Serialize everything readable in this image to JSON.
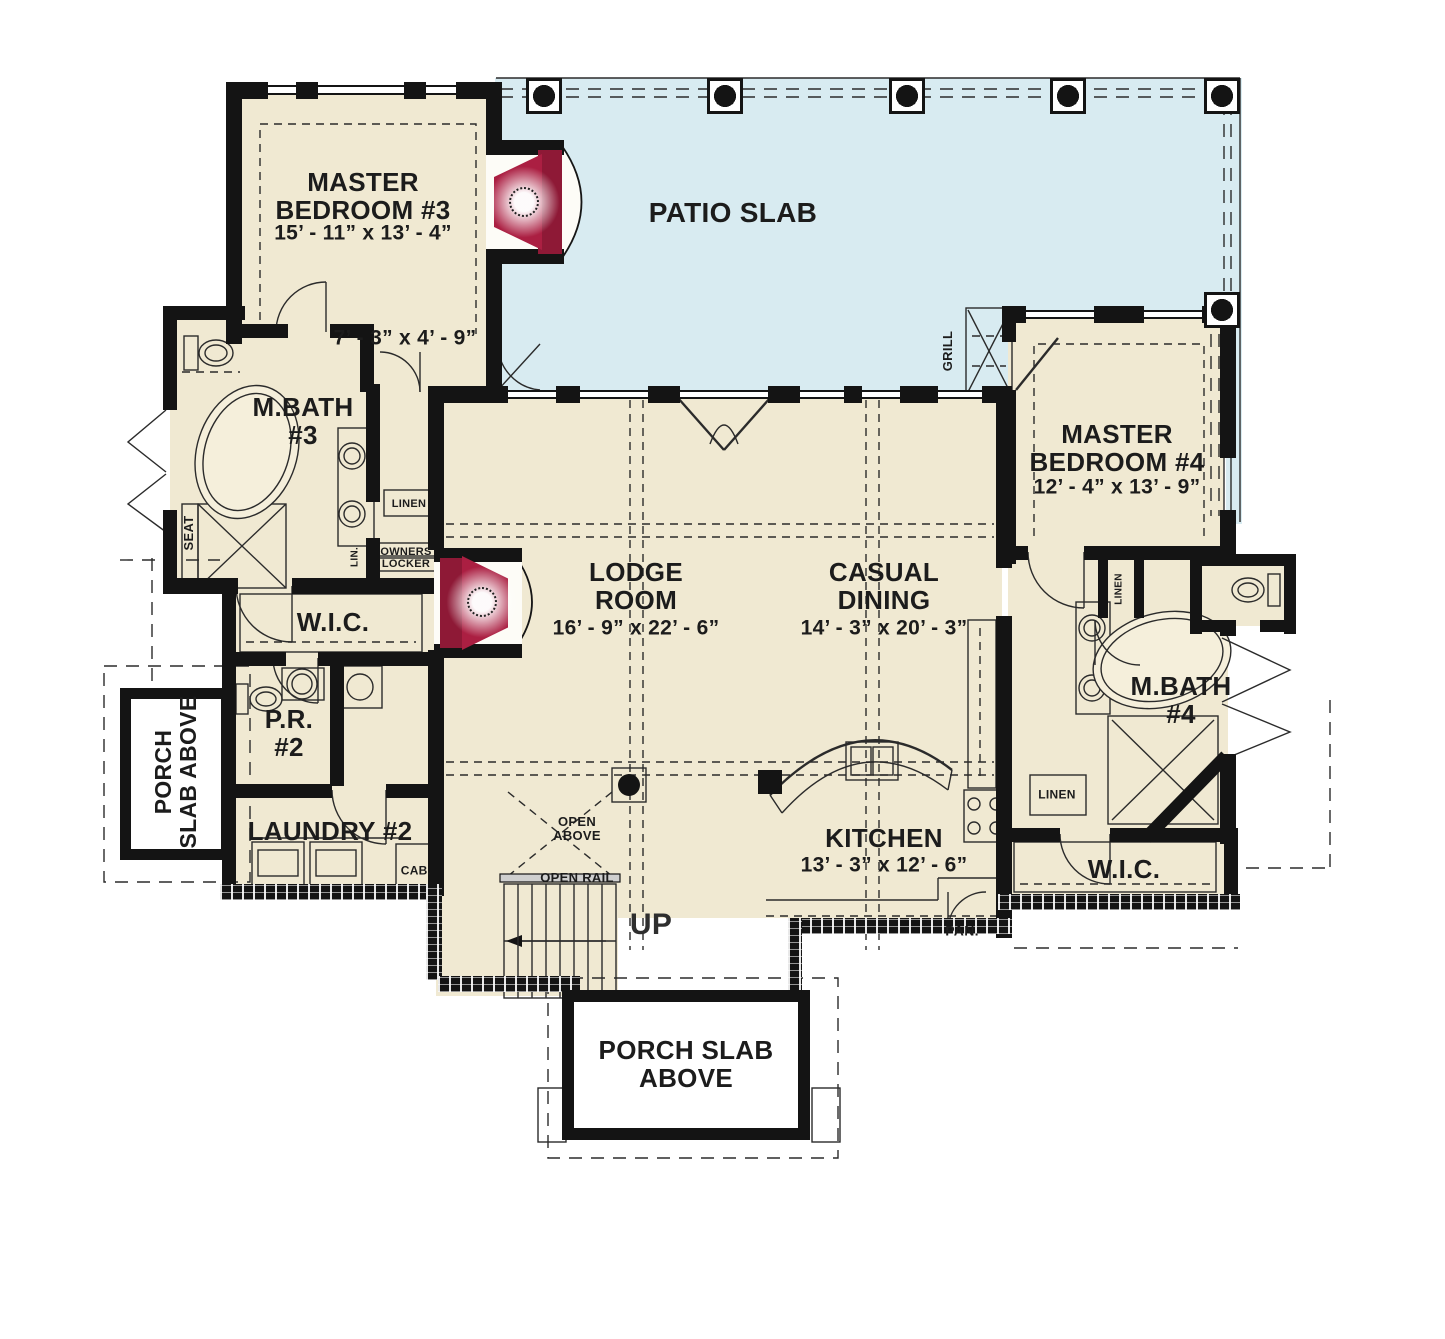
{
  "colors": {
    "interior": "#f0e9d2",
    "patio": "#d8ebf1",
    "wall": "#141414",
    "accent_red": "#ab1f42",
    "line": "#2b2b2b"
  },
  "rooms": {
    "patio": {
      "name": "PATIO SLAB"
    },
    "master_bedroom_3": {
      "name": "MASTER\nBEDROOM #3",
      "dims": "15’ - 11” x 13’ - 4”"
    },
    "vestibule": {
      "dims": "7’ - 3” x 4’ - 9”"
    },
    "m_bath_3": {
      "name": "M.BATH\n#3"
    },
    "wic_left": {
      "name": "W.I.C."
    },
    "powder_2": {
      "name": "P.R.\n#2"
    },
    "laundry_2": {
      "name": "LAUNDRY #2"
    },
    "lodge_room": {
      "name": "LODGE\nROOM",
      "dims": "16’ - 9” x 22’ - 6”"
    },
    "casual_dining": {
      "name": "CASUAL\nDINING",
      "dims": "14’ - 3” x 20’ - 3”"
    },
    "kitchen": {
      "name": "KITCHEN",
      "dims": "13’ - 3” x 12’ - 6”"
    },
    "master_bedroom_4": {
      "name": "MASTER\nBEDROOM #4",
      "dims": "12’ - 4” x 13’ - 9”"
    },
    "m_bath_4": {
      "name": "M.BATH\n#4"
    },
    "wic_right": {
      "name": "W.I.C."
    },
    "porch_left": {
      "name": "PORCH\nSLAB ABOVE"
    },
    "porch_bottom": {
      "name": "PORCH SLAB\nABOVE"
    }
  },
  "annotations": {
    "seat": "SEAT",
    "linen_bath3": "LINEN",
    "owners_locker": "OWNERS\nLOCKER",
    "lin": "LIN.",
    "grill": "GRILL",
    "open_above": "OPEN\nABOVE",
    "open_rail": "OPEN RAIL",
    "up": "UP",
    "cab": "CAB.",
    "pan": "PAN.",
    "linen_hall4": "LINEN",
    "linen_bath4": "LINEN"
  }
}
